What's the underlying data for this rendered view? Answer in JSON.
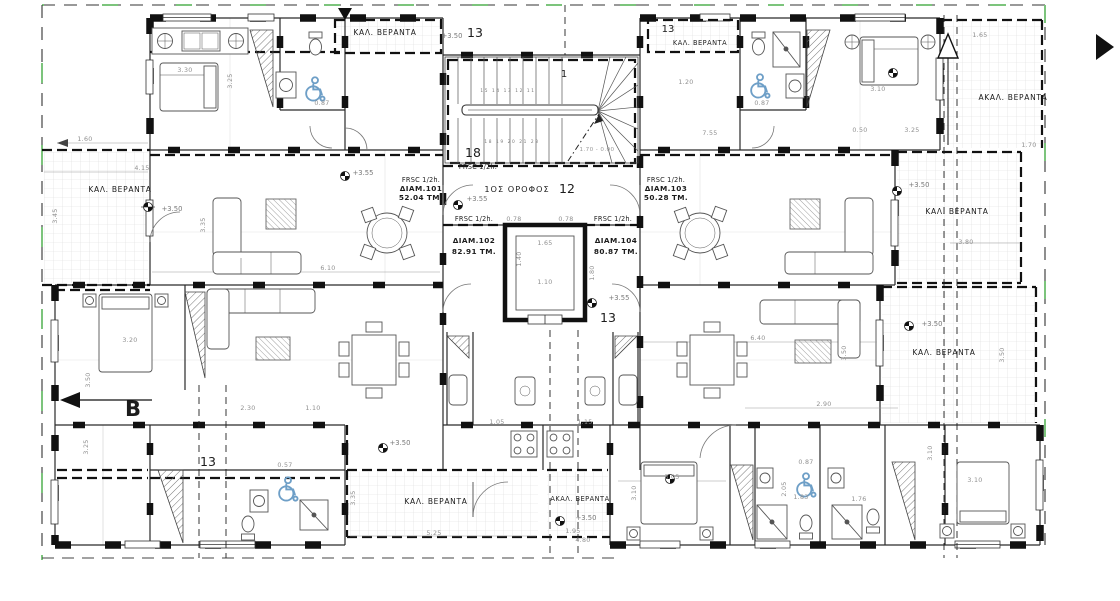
{
  "colors": {
    "accent_blue": "#6e9fc7",
    "boundary_green": "#7cc47c",
    "ink": "#1c1c1c",
    "dim_gray": "#8f8f8f"
  },
  "plan": {
    "floor_label": "1ΟΣ ΟΡΟΦΟΣ",
    "fire_rating": "FRSC 1/2h.",
    "apartments": [
      {
        "name": "ΔΙΑΜ.101",
        "area": "52.04 ΤΜ."
      },
      {
        "name": "ΔΙΑΜ.102",
        "area": "82.91 ΤΜ."
      },
      {
        "name": "ΔΙΑΜ.103",
        "area": "50.28 ΤΜ."
      },
      {
        "name": "ΔΙΑΜ.104",
        "area": "80.87 ΤΜ."
      }
    ],
    "labels": {
      "covered_veranda": "ΚΑΛ. ΒΕΡΑΝΤΑ",
      "uncovered_veranda": "ΑΚΑΛ. ΒΕΡΑΝΤΑ"
    },
    "grid": {
      "n13": "13",
      "n18": "18",
      "n1": "1",
      "n12": "12",
      "section": "B"
    },
    "levels": {
      "l350": "+3.50",
      "l355": "+3.55"
    },
    "stairs": {
      "treads_up": "15 14 13 12 11",
      "treads_down": "18 19 20 21 23",
      "level_note": "1.70 - 0.00"
    },
    "dims": {
      "d330": "3.30",
      "d325": "3.25",
      "d160": "1.60",
      "d087": "0.87",
      "d415": "4.15",
      "d345": "3.45",
      "d610": "6.10",
      "d078": "0.78",
      "d165": "1.65",
      "d110": "1.10",
      "d140": "1.40",
      "d180": "1.80",
      "d380": "3.80",
      "d350": "3.50",
      "d320": "3.20",
      "d305": "3.05",
      "d310": "3.10",
      "d205": "2.05",
      "d183": "1.83",
      "d176": "1.76",
      "d525": "5.25",
      "d195": "1.95",
      "d480": "4.80",
      "d105": "1.05",
      "d115": "1.15",
      "d230": "2.30",
      "d057": "0.57",
      "d640": "6.40",
      "d290": "2.90",
      "d120": "1.20",
      "d755": "7.55",
      "d050": "0.50",
      "d170": "1.70",
      "d335": "3.35"
    }
  }
}
